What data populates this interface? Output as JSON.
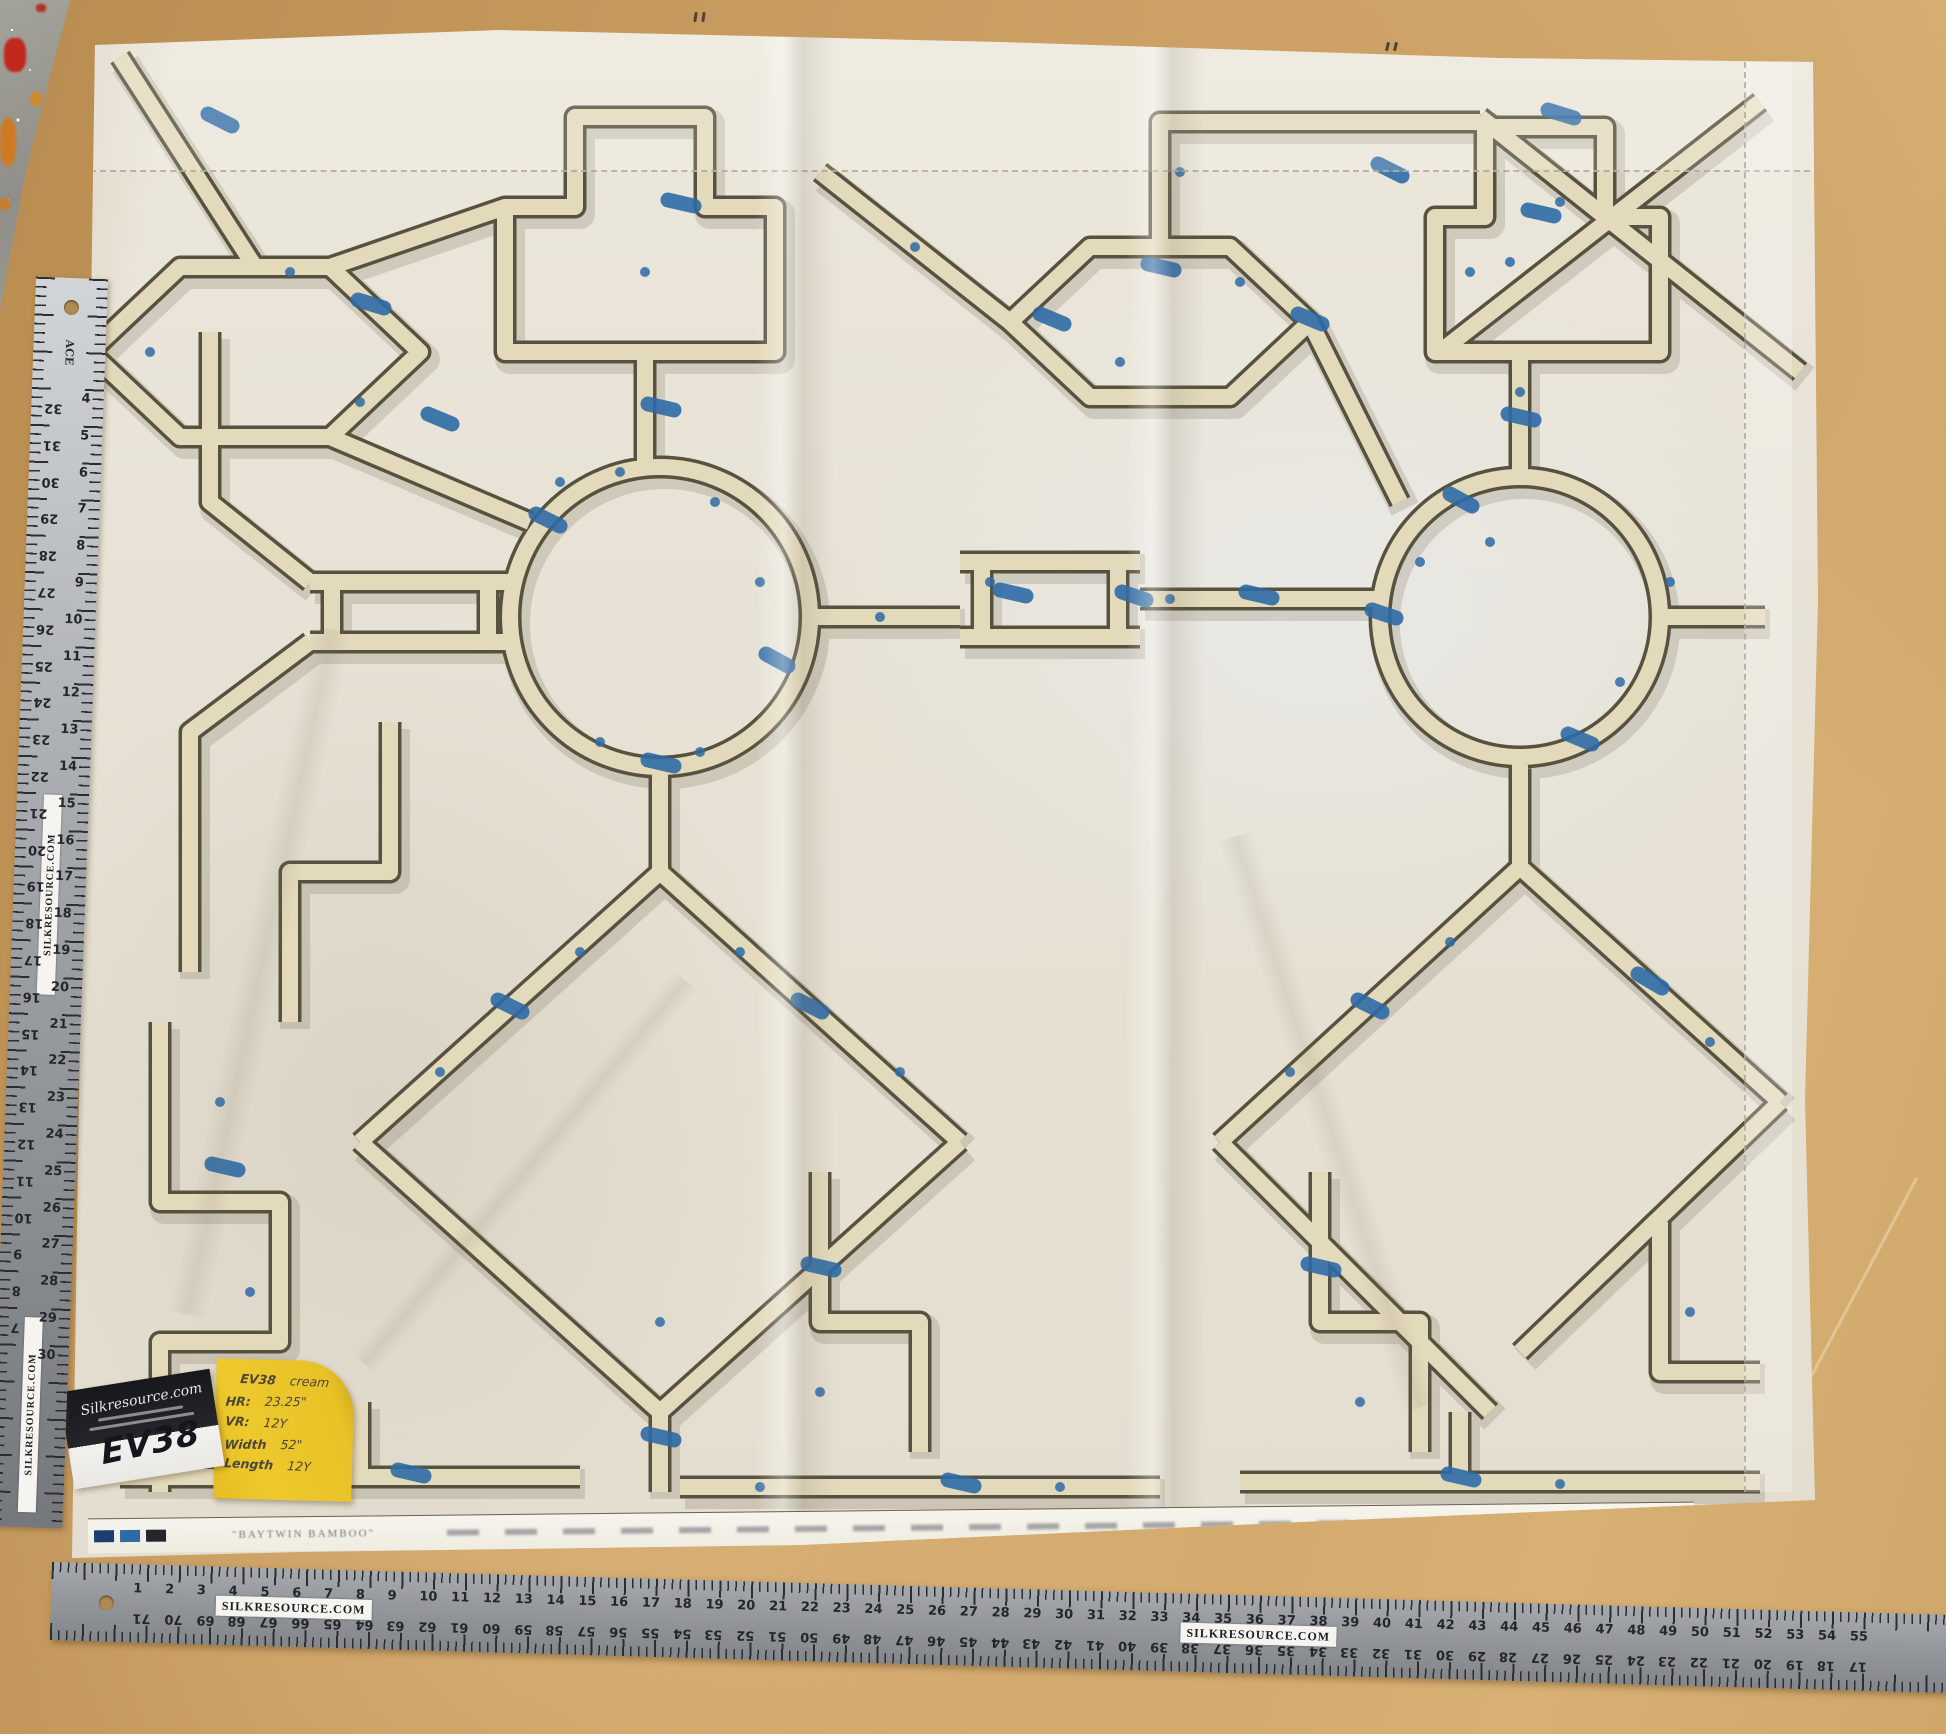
{
  "scene": {
    "description": "Cream bamboo-trellis fabric panel laid on a wooden table, measured by two rulers",
    "table_color": "#c79a5e",
    "fabric_color": "#e8e3d6",
    "bamboo_color": "#e3d9bb",
    "accent_blue": "#2e6aa6"
  },
  "sticky_note": {
    "lines": [
      {
        "label": "EV38",
        "value": "cream"
      },
      {
        "label": "HR:",
        "value": "23.25\""
      },
      {
        "label": "VR:",
        "value": "12Y"
      },
      {
        "label": "Width",
        "value": "52\""
      },
      {
        "label": "Length",
        "value": "12Y"
      }
    ]
  },
  "business_card": {
    "brand": "Silkresource.com",
    "handwritten_code": "EV38"
  },
  "selvage": {
    "text": "\"BAYTWIN BAMBOO\""
  },
  "rulers": {
    "sticker_text": "SILKRESOURCE.COM",
    "left": {
      "brand": "ACE",
      "right_scale": {
        "from": 4,
        "to": 30
      },
      "left_scale": {
        "from": 32,
        "to": 7
      },
      "inch_px": 36.8,
      "origin_px": 120
    },
    "bottom": {
      "top_scale": {
        "from": 1,
        "to": 55
      },
      "reverse_total": 72,
      "inch_px": 31.8,
      "origin_px": 90
    }
  }
}
